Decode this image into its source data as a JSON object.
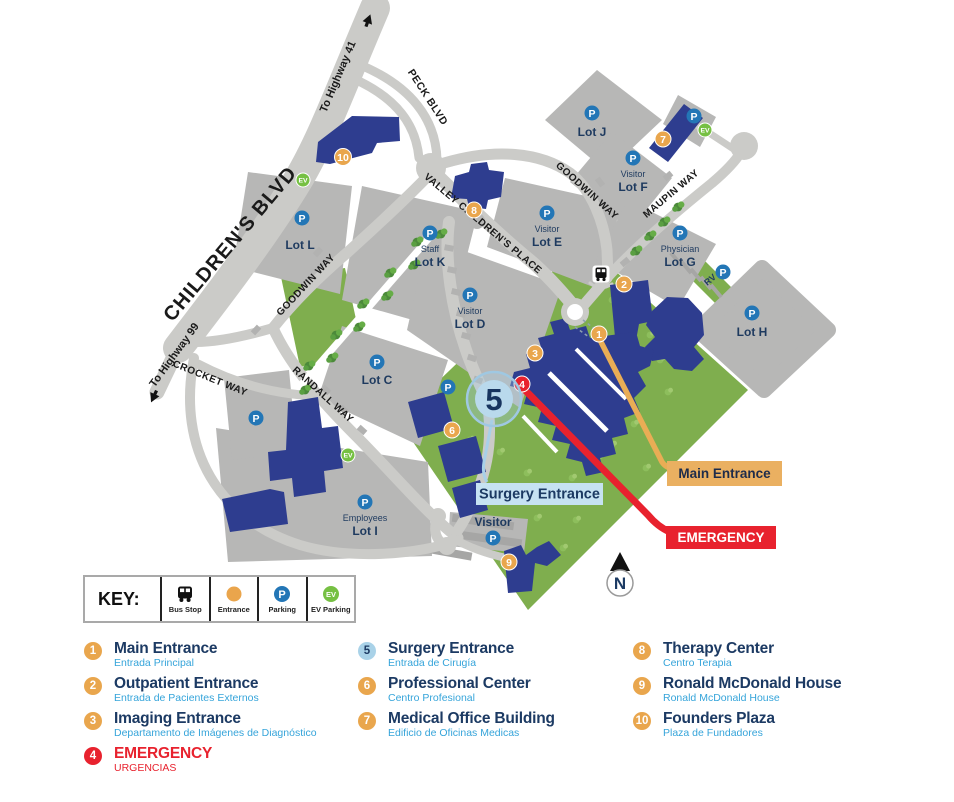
{
  "colors": {
    "building_navy": "#2e3d8f",
    "road_gray": "#cbcbc8",
    "lot_gray": "#b7b7b6",
    "campus_green": "#7fae4e",
    "marker_orange": "#e9a64d",
    "emergency_red": "#e8222e",
    "surgery_light_blue": "#a9d2e8",
    "parking_blue": "#2376b6",
    "ev_green": "#76c043",
    "title_navy": "#1c3a63",
    "subtitle_blue": "#35a4da"
  },
  "map": {
    "roads": {
      "childrens_blvd": "CHILDREN'S BLVD",
      "to_highway_41": "To Highway 41",
      "to_highway_99": "To Highway 99",
      "peck_blvd": "PECK BLVD",
      "valley_childrens_place": "VALLEY CHILDREN'S PLACE",
      "goodwin_way_upper": "GOODWIN WAY",
      "goodwin_way_lower": "GOODWIN WAY",
      "maupin_way": "MAUPIN WAY",
      "crocket_way": "CROCKET WAY",
      "randall_way": "RANDALL WAY"
    },
    "lots": {
      "lot_l": {
        "name": "Lot L"
      },
      "lot_k": {
        "sub": "Staff",
        "name": "Lot K"
      },
      "lot_e": {
        "sub": "Visitor",
        "name": "Lot E"
      },
      "lot_j": {
        "name": "Lot J"
      },
      "lot_f": {
        "sub": "Visitor",
        "name": "Lot F"
      },
      "lot_g": {
        "sub": "Physician",
        "name": "Lot G"
      },
      "lot_h": {
        "name": "Lot H"
      },
      "lot_d": {
        "sub": "Visitor",
        "name": "Lot D"
      },
      "lot_c": {
        "name": "Lot C"
      },
      "lot_i": {
        "sub": "Employees",
        "name": "Lot I"
      },
      "visitor_south": {
        "sub": "Visitor"
      },
      "rv": {
        "name": "RV"
      }
    },
    "icons": {
      "parking_letter": "P",
      "ev_letter": "EV"
    },
    "callouts": {
      "surgery": "Surgery Entrance",
      "main": "Main Entrance",
      "emergency": "EMERGENCY"
    },
    "compass_n": "N"
  },
  "key": {
    "title": "KEY:",
    "items": [
      {
        "icon": "bus-icon",
        "label": "Bus Stop"
      },
      {
        "icon": "entrance-dot-icon",
        "label": "Entrance"
      },
      {
        "icon": "parking-icon",
        "label": "Parking"
      },
      {
        "icon": "ev-parking-icon",
        "label": "EV Parking"
      }
    ]
  },
  "legend": {
    "items": [
      {
        "num": "1",
        "title": "Main Entrance",
        "subtitle": "Entrada Principal",
        "type": "entrance"
      },
      {
        "num": "2",
        "title": "Outpatient Entrance",
        "subtitle": "Entrada de Pacientes Externos",
        "type": "entrance"
      },
      {
        "num": "3",
        "title": "Imaging Entrance",
        "subtitle": "Departamento de Imágenes de Diagnóstico",
        "type": "entrance"
      },
      {
        "num": "4",
        "title": "EMERGENCY",
        "subtitle": "URGENCIAS",
        "type": "emergency"
      },
      {
        "num": "5",
        "title": "Surgery Entrance",
        "subtitle": "Entrada de Cirugía",
        "type": "surgery"
      },
      {
        "num": "6",
        "title": "Professional Center",
        "subtitle": "Centro Profesional",
        "type": "entrance"
      },
      {
        "num": "7",
        "title": "Medical Office Building",
        "subtitle": "Edificio de Oficinas Medicas",
        "type": "entrance"
      },
      {
        "num": "8",
        "title": "Therapy Center",
        "subtitle": "Centro Terapia",
        "type": "entrance"
      },
      {
        "num": "9",
        "title": "Ronald McDonald House",
        "subtitle": "Ronald McDonald House",
        "type": "entrance"
      },
      {
        "num": "10",
        "title": "Founders Plaza",
        "subtitle": "Plaza de Fundadores",
        "type": "entrance"
      }
    ]
  }
}
